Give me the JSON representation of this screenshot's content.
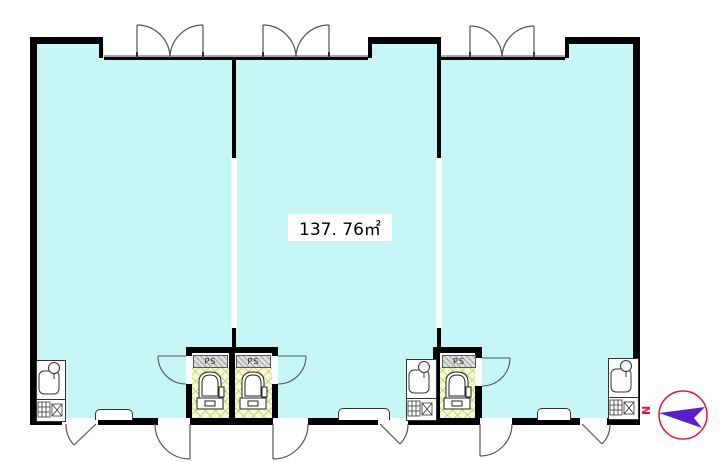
{
  "plan": {
    "area_label": "137. 76㎡",
    "ps_labels": [
      "PS",
      "PS",
      "PS"
    ],
    "compass": {
      "north_label": "N"
    },
    "colors": {
      "room_fill": "#c6f6f6",
      "wall": "#000000",
      "toilet_floor": "#fbf8d2",
      "toilet_hatch": "#8cc85a",
      "ps_shaft_gray": "#dedede",
      "compass_ring": "#e0143c",
      "compass_needle": "#5a1fc8",
      "door_line": "#555555"
    }
  }
}
